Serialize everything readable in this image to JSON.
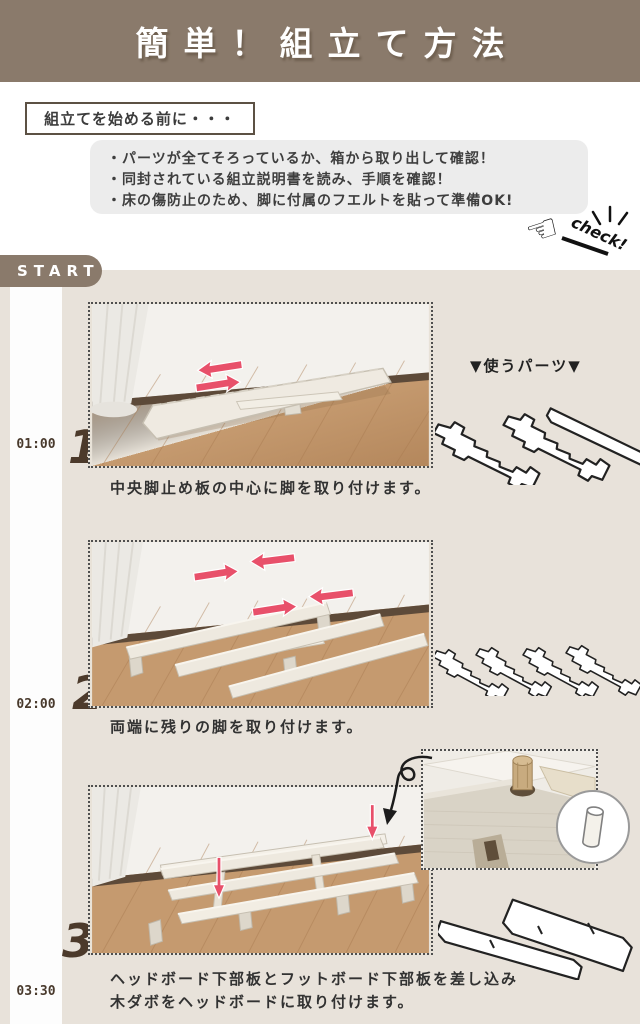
{
  "header": {
    "title": "簡単！組立て方法"
  },
  "intro": {
    "label": "組立てを始める前に・・・",
    "bullets": [
      "・パーツが全てそろっているか、箱から取り出して確認！",
      "・同封されている組立説明書を読み、手順を確認！",
      "・床の傷防止のため、脚に付属のフエルトを貼って準備OK!"
    ],
    "check_label": "check!"
  },
  "start_label": "START",
  "parts_label": "▼使うパーツ▼",
  "steps": [
    {
      "number": "1",
      "time": "01:00",
      "caption": "中央脚止め板の中心に脚を取り付けます。"
    },
    {
      "number": "2",
      "time": "02:00",
      "caption": "両端に残りの脚を取り付けます。"
    },
    {
      "number": "3",
      "time": "03:30",
      "caption_line1": "ヘッドボード下部板とフットボード下部板を差し込み",
      "caption_line2": "木ダボをヘッドボードに取り付けます。"
    }
  ],
  "icons": {
    "check_hand": "☜"
  },
  "colors": {
    "brown": "#8a7a6b",
    "beige": "#e8e2da",
    "ink": "#333333",
    "red": "#e8506a",
    "gray_box": "#ececec",
    "timeline_brown": "#493a2d",
    "white": "#ffffff"
  }
}
